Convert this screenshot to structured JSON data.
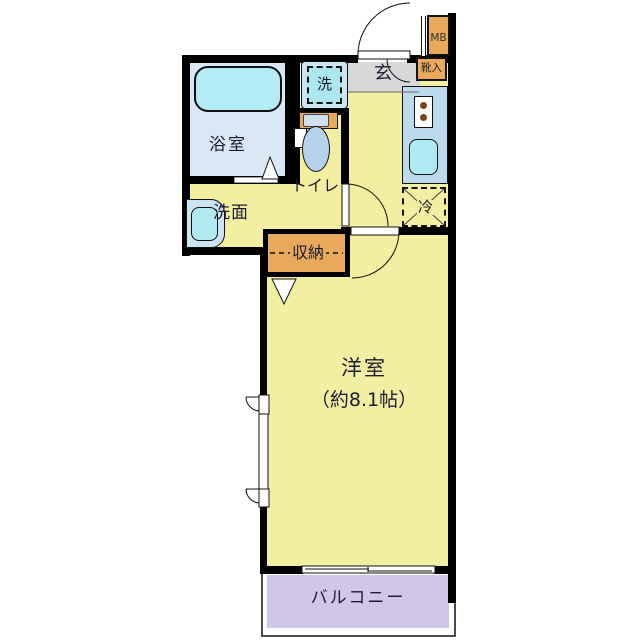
{
  "floorplan": {
    "labels": {
      "bathroom": "浴室",
      "washroom": "洗面",
      "toilet": "トイレ",
      "washing_machine": "洗",
      "entrance": "玄",
      "shoe_cabinet": "靴入",
      "meter_box": "MB",
      "refrigerator": "冷",
      "storage": "収納",
      "western_room": "洋室",
      "western_room_size": "（約8.1帖）",
      "balcony": "バルコニー"
    },
    "colors": {
      "wall": "#000000",
      "room_yellow": "#f2efa2",
      "bathroom_blue": "#dae8f5",
      "bathtub_cyan": "#b3ecf4",
      "kitchen_counter_blue": "#bcd9ee",
      "sink_cyan": "#aeeaf2",
      "cabinet_orange": "#e9a95c",
      "entrance_gray": "#d8d8d8",
      "balcony_lavender": "#cfc6e9"
    }
  }
}
